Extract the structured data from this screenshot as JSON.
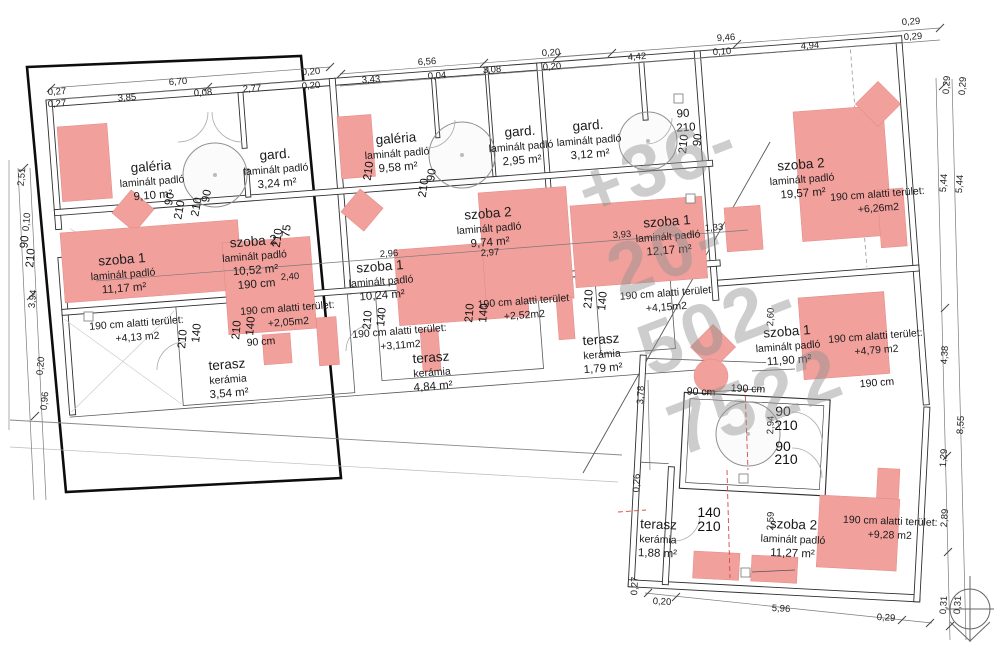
{
  "watermark": "+36-20-502-7522",
  "rooms": {
    "u1_galeria": {
      "name": "galéria",
      "floor": "laminált padló",
      "area": "9,10 m²"
    },
    "u1_gard": {
      "name": "gard.",
      "floor": "laminált padló",
      "area": "3,24 m²"
    },
    "u1_szoba1": {
      "name": "szoba 1",
      "floor": "laminált padló",
      "area": "11,17 m²"
    },
    "u1_szoba2": {
      "name": "szoba 2",
      "floor": "laminált padló",
      "area": "10,52 m²",
      "extra": "190 cm"
    },
    "u1_terasz": {
      "name": "terasz",
      "floor": "kerámia",
      "area": "3,54 m²"
    },
    "u2_galeria": {
      "name": "galéria",
      "floor": "laminált padló",
      "area": "9,58 m²"
    },
    "u2_gard": {
      "name": "gard.",
      "floor": "laminált padló",
      "area": "2,95 m²"
    },
    "u2_szoba1": {
      "name": "szoba 1",
      "floor": "laminált padló",
      "area": "10,24 m²"
    },
    "u2_szoba2": {
      "name": "szoba 2",
      "floor": "laminált padló",
      "area": "9,74 m²"
    },
    "u2_terasz": {
      "name": "terasz",
      "floor": "kerámia",
      "area": "4,84 m²"
    },
    "u3_gard": {
      "name": "gard.",
      "floor": "laminált padló",
      "area": "3,12 m²"
    },
    "u3_szoba1": {
      "name": "szoba 1",
      "floor": "laminált padló",
      "area": "12,17 m²"
    },
    "u3_terasz": {
      "name": "terasz",
      "floor": "kerámia",
      "area": "1,79 m²"
    },
    "u4_szoba2_top": {
      "name": "szoba 2",
      "floor": "laminált padló",
      "area": "19,57 m²"
    },
    "u4_szoba1": {
      "name": "szoba 1",
      "floor": "laminált padló",
      "area": "11,90 m²"
    },
    "u4_szoba2_bottom": {
      "name": "szoba 2",
      "floor": "laminált padló",
      "area": "11,27 m²"
    },
    "u4_terasz": {
      "name": "terasz",
      "floor": "kerámia",
      "area": "1,88 m²"
    }
  },
  "annotations": {
    "a1": {
      "label": "190 cm alatti terület:",
      "value": "+4,13 m2"
    },
    "a2": {
      "label": "190 cm alatti terület:",
      "value": "+2,05m2"
    },
    "a3": {
      "label": "190 cm alatti terület:",
      "value": "+3,11m2"
    },
    "a4": {
      "label": "190 cm alatti terület",
      "value": "+2,52m2"
    },
    "a5": {
      "label": "190 cm alatti terület",
      "value": "+4,15m2"
    },
    "a6": {
      "label": "190 cm alatti terület:",
      "value": "+6,26m2"
    },
    "a7": {
      "label": "190 cm alatti terület:",
      "value": "+4,79 m2"
    },
    "a8": {
      "label": "190 cm alatti terület:",
      "value": "+9,28 m2"
    }
  },
  "doors": {
    "d90": "90",
    "d210": "210",
    "d140": "140",
    "d75": "75"
  },
  "clearance": {
    "cm90": "90 cm",
    "cm190": "190 cm"
  },
  "dims": {
    "t670": "6,70",
    "t027a": "0,27",
    "t027b": "0,27",
    "t385": "3,85",
    "t008": "0,08",
    "t277": "2,77",
    "t020a": "0,20",
    "t020b": "0,20",
    "t343": "3,43",
    "t656": "6,56",
    "t004": "0,04",
    "t308": "3,08",
    "t020c": "0,20",
    "t020d": "0,20",
    "t442": "4,42",
    "t946": "9,46",
    "t010": "0,10",
    "t494": "4,94",
    "t029a": "0,29",
    "t029b": "0,29",
    "r029a": "0,29",
    "r029b": "0,29",
    "r544a": "5,44",
    "r544b": "5,44",
    "r438": "4,38",
    "r855": "8,55",
    "r129": "1,29",
    "r289": "2,89",
    "l251": "2,51",
    "l010": "0,10",
    "l394": "3,94",
    "l020": "0,20",
    "l096": "0,96",
    "b026": "0,26",
    "b027": "0,27",
    "b020": "0,20",
    "b596": "5,96",
    "b029": "0,29",
    "b031a": "0,31",
    "b031b": "0,31",
    "b378": "3,78",
    "b294": "2,94",
    "b259": "2,59",
    "b260": "2,60",
    "m296": "2,96",
    "m297": "2,97",
    "m393": "3,93",
    "m133": "1,33",
    "m240": "2,40"
  }
}
